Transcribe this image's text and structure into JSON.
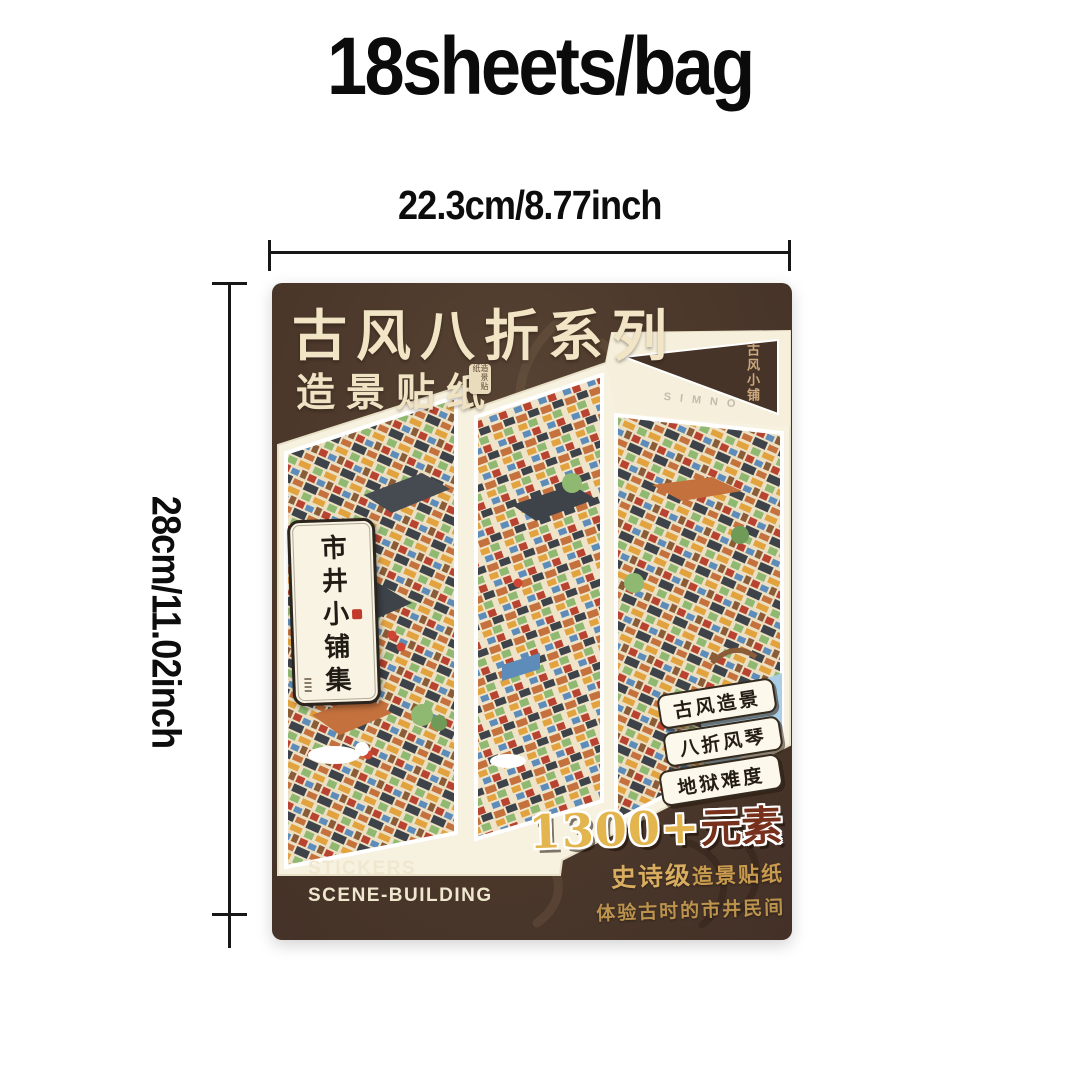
{
  "header": {
    "title": "18sheets/bag"
  },
  "dimensions": {
    "width_label": "22.3cm/8.77inch",
    "height_label": "28cm/11.02inch"
  },
  "package": {
    "series_title": "古风八折系列",
    "subtitle": "造景贴纸",
    "seal_text": "造景贴纸",
    "corner_mark": "古风小铺",
    "brand_mark": "SIMNO",
    "plaque_vertical_title": "市井小铺集",
    "badges": [
      "古风造景",
      "八折风琴",
      "地狱难度"
    ],
    "highlight_number": "1300+",
    "highlight_unit": "元素",
    "promo_line1_strong": "史诗级",
    "promo_line1_rest": "造景贴纸",
    "promo_line2": "体验古时的市井民间",
    "footer_line1": "STICKERS",
    "footer_line2": "SCENE-BUILDING",
    "colors": {
      "package_brown": "#4c392c",
      "cream_text": "#f1e5c6",
      "gold_text": "#d8ad60",
      "highlight_gold": "#e3b54e",
      "highlight_red": "#76301c",
      "badge_bg": "#fcf8ec",
      "paper_cream": "#f7f1e0"
    }
  }
}
